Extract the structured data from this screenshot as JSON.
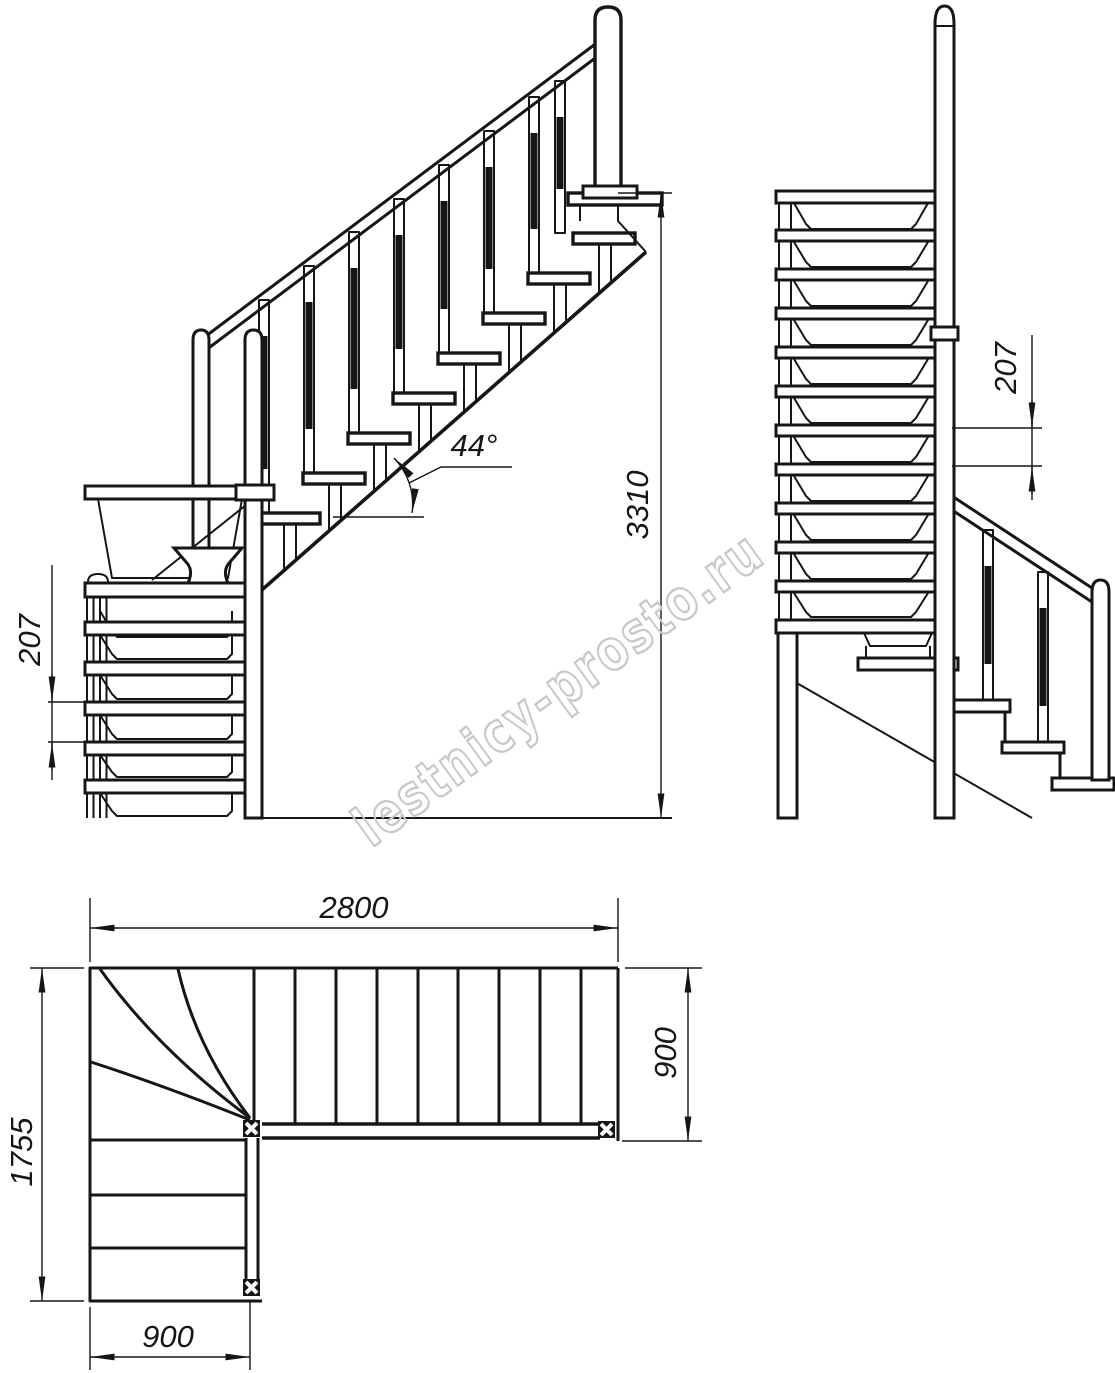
{
  "drawing": {
    "type": "technical-blueprint",
    "subject": "L-shaped winder staircase, three orthographic views",
    "colors": {
      "line": "#161616",
      "watermark": "#c8c8c8",
      "background": "#ffffff"
    },
    "watermark": "lestnicy-prosto.ru",
    "views": {
      "front_elevation": {
        "angle_label": "44°",
        "total_height_label": "3310",
        "step_rise_label": "207"
      },
      "side_elevation": {
        "step_rise_label": "207"
      },
      "plan": {
        "total_length_label": "2800",
        "upper_flight_width_label": "900",
        "total_width_label": "1755",
        "lower_flight_width_label": "900"
      }
    }
  }
}
